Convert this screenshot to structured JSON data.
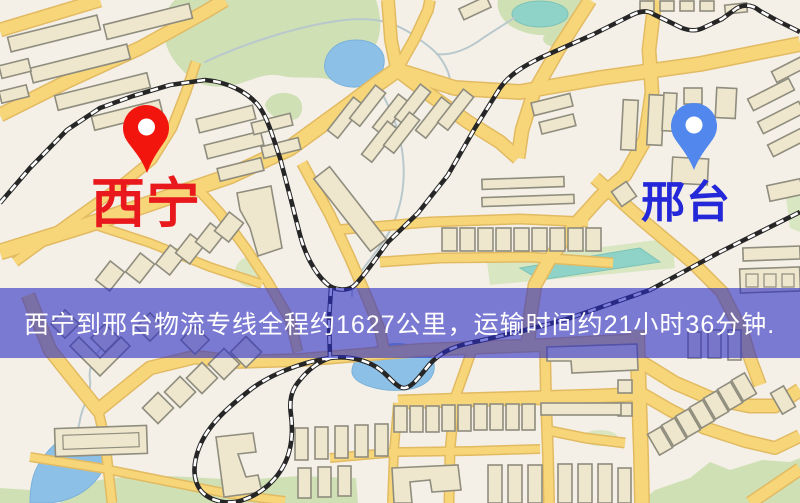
{
  "map": {
    "markers": [
      {
        "id": "xining",
        "label": "西宁",
        "label_color": "#e8181c",
        "pin_color": "#f2150d"
      },
      {
        "id": "xingtai",
        "label": "邢台",
        "label_color": "#2428d8",
        "pin_color": "#5287ee"
      }
    ]
  },
  "banner": {
    "text": "西宁到邢台物流专线全程约1627公里，运输时间约21小时36分钟.",
    "bg": "rgba(42,44,196,0.6)",
    "text_color": "#ffffff"
  },
  "route": {
    "origin": "西宁",
    "destination": "邢台",
    "distance_km": "1627",
    "duration": "21小时36分钟"
  },
  "colors": {
    "map_background": "#f4f0e8",
    "road_fill": "#f6d678",
    "road_border": "#e2ba62",
    "building_fill": "#eee6cd",
    "building_border": "#8f8d7e",
    "park_green": "#cfe0b4",
    "water_blue": "#8cc0e6",
    "water_teal": "#8fd2c8",
    "railway": "#262626"
  }
}
